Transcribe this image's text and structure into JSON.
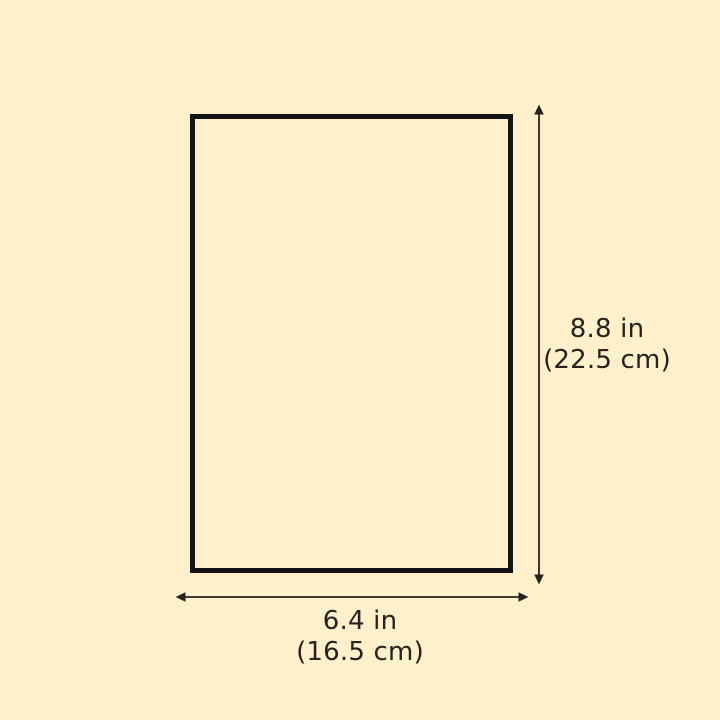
{
  "diagram": {
    "colors": {
      "background": "#FDF0CB",
      "line": "#26221D",
      "border": "#141414"
    },
    "height_label": {
      "primary": "8.8 in",
      "secondary": "(22.5 cm)"
    },
    "width_label": {
      "primary": "6.4 in",
      "secondary": "(16.5 cm)"
    }
  }
}
